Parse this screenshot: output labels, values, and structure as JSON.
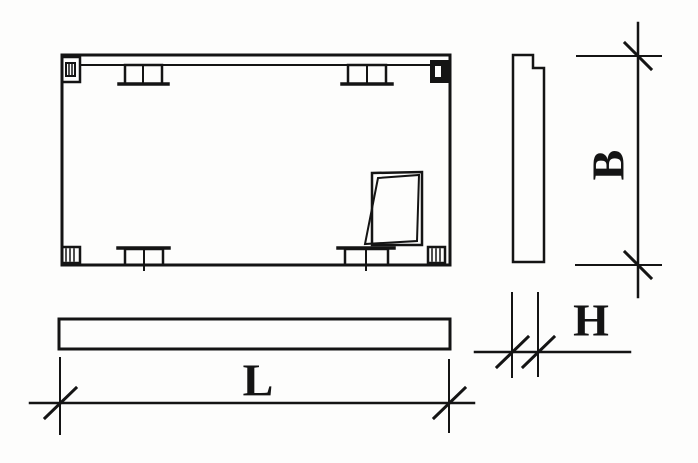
{
  "drawing": {
    "labels": {
      "length": "L",
      "width": "B",
      "thickness": "H"
    },
    "colors": {
      "ink": "#141414",
      "paper": "#fdfdfc"
    }
  }
}
